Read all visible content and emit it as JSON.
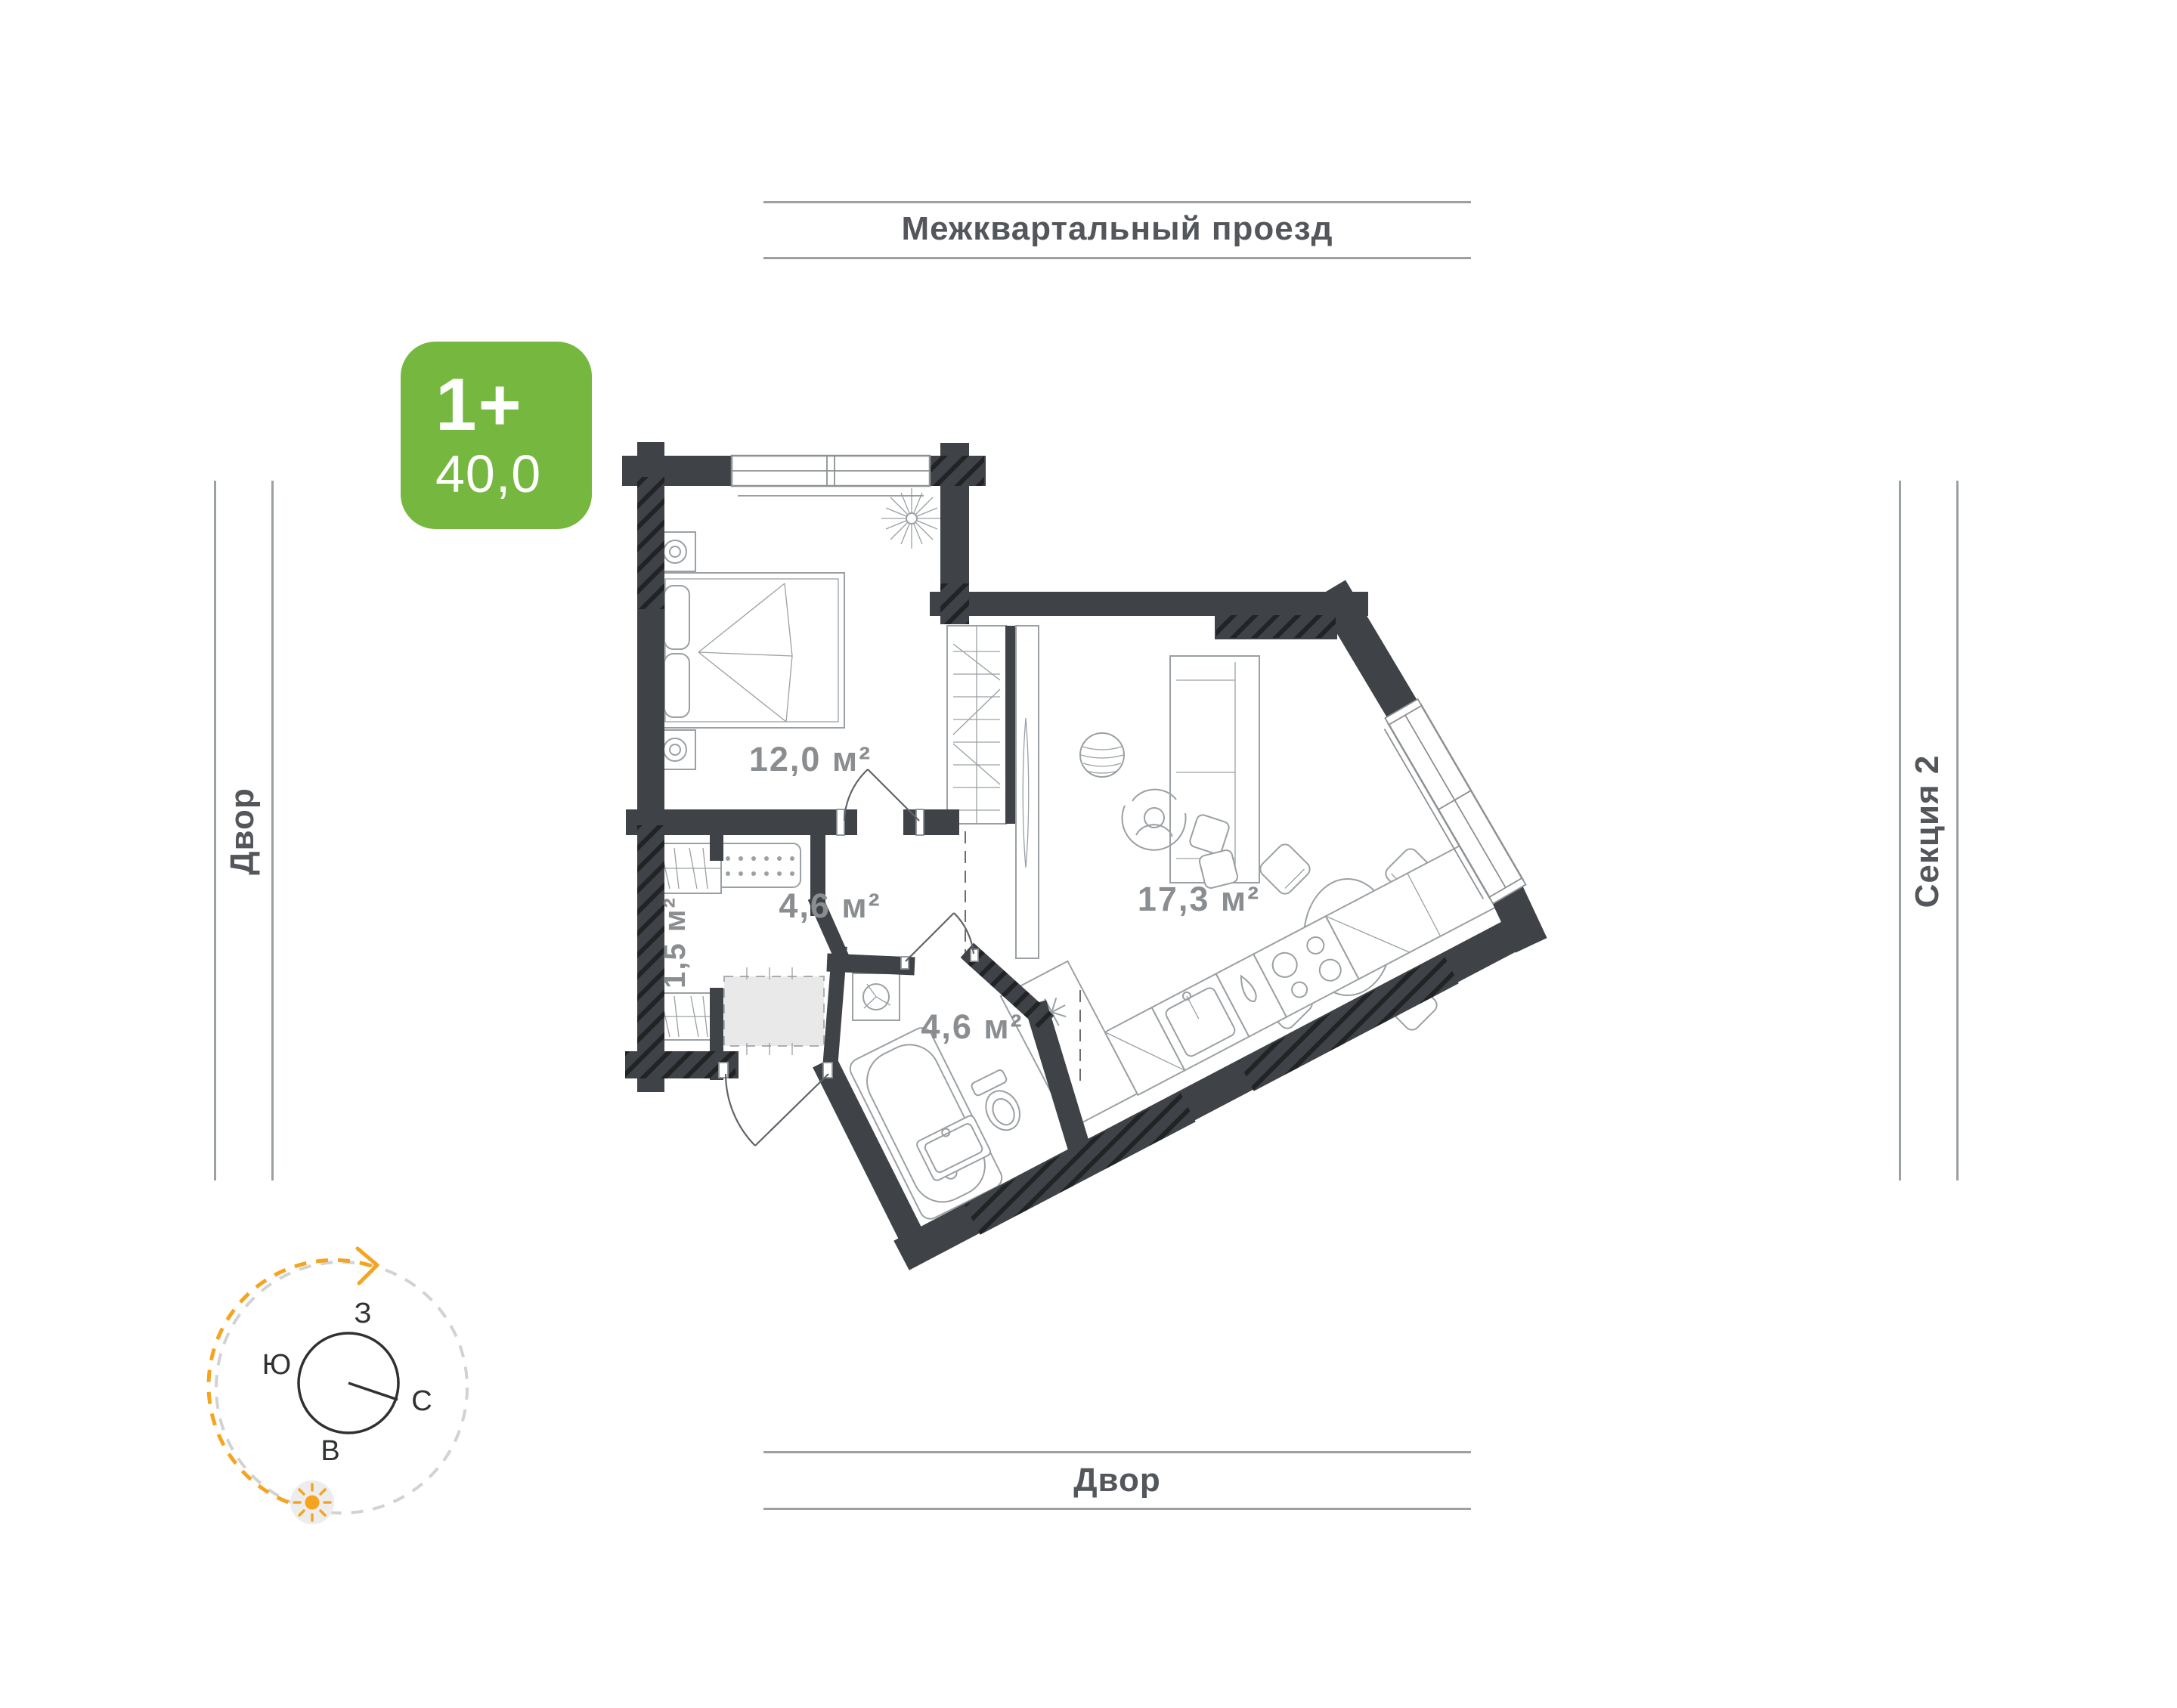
{
  "streets": {
    "top": "Межквартальный проезд",
    "bottom": "Двор",
    "left": "Двор",
    "right": "Секция 2"
  },
  "badge": {
    "rooms": "1+",
    "area": "40,0",
    "color": "#76b83f"
  },
  "plan": {
    "wall_color": "#3f4347",
    "furniture_line_color": "#9aa0a3",
    "rooms": [
      {
        "id": "bedroom",
        "area": "12,0 м²"
      },
      {
        "id": "hallway",
        "area": "4,6 м²"
      },
      {
        "id": "bathroom",
        "area": "4,6 м²"
      },
      {
        "id": "storage",
        "area": "1,5 м²"
      },
      {
        "id": "living_kitchen",
        "area": "17,3 м²"
      }
    ]
  },
  "compass": {
    "north": "С",
    "south": "Ю",
    "west": "З",
    "east": "В",
    "accent": "#f6a41f"
  }
}
